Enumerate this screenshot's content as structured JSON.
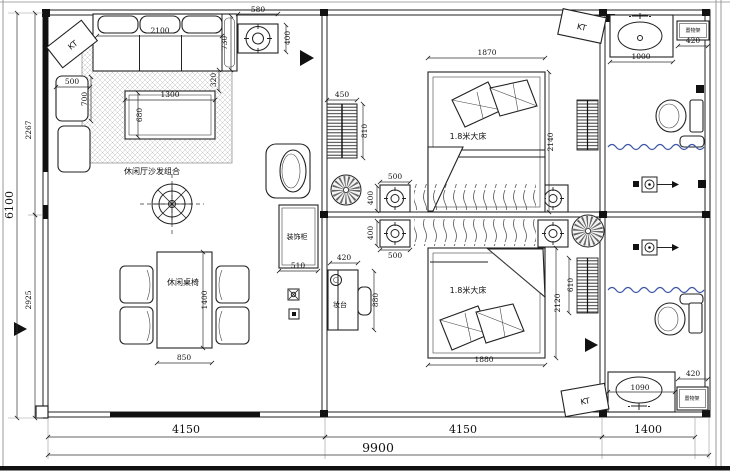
{
  "plan": {
    "type": "residential floor plan",
    "rooms": [
      "leisure hall",
      "bedroom",
      "bedroom",
      "bathroom",
      "bathroom"
    ]
  },
  "labels": {
    "sofa_group": "休闲厅沙发组合",
    "dining_set": "休闲桌椅",
    "bed": "1.8米大床",
    "deco_cabinet": "装饰柜",
    "dresser": "妆台",
    "shelf": "置物架",
    "ac": "KT"
  },
  "dims": {
    "bottom1": "4150",
    "bottom2": "4150",
    "bottom3": "1400",
    "bottom_total": "9900",
    "left_total": "6100",
    "left_top": "2267",
    "left_bottom": "2925",
    "light_w": "580",
    "light_d": "400",
    "sofa_w": "2100",
    "sofa_arm": "730",
    "sofa_off": "320",
    "side_sofa_w": "500",
    "side_sofa_d": "700",
    "coffee_w": "1300",
    "coffee_d": "680",
    "dining_w": "850",
    "dining_l": "1400",
    "cabinet_w": "450",
    "cabinet_d": "810",
    "ns_w1": "500",
    "ns_d1": "400",
    "ns_d2": "400",
    "ns_w2": "500",
    "deco_w": "510",
    "dresser_w": "420",
    "dresser_l": "880",
    "bed1_w": "1870",
    "bed1_l": "2140",
    "bed2_w": "1880",
    "bed2_l": "2120",
    "strip_d": "610",
    "vanity1_w": "1000",
    "shelf1_w": "420",
    "vanity2_w": "1090",
    "shelf2_w": "420"
  },
  "colors": {
    "line": "#111111",
    "curtain": "#3b56a8",
    "hatch": "#c4c4c4"
  }
}
